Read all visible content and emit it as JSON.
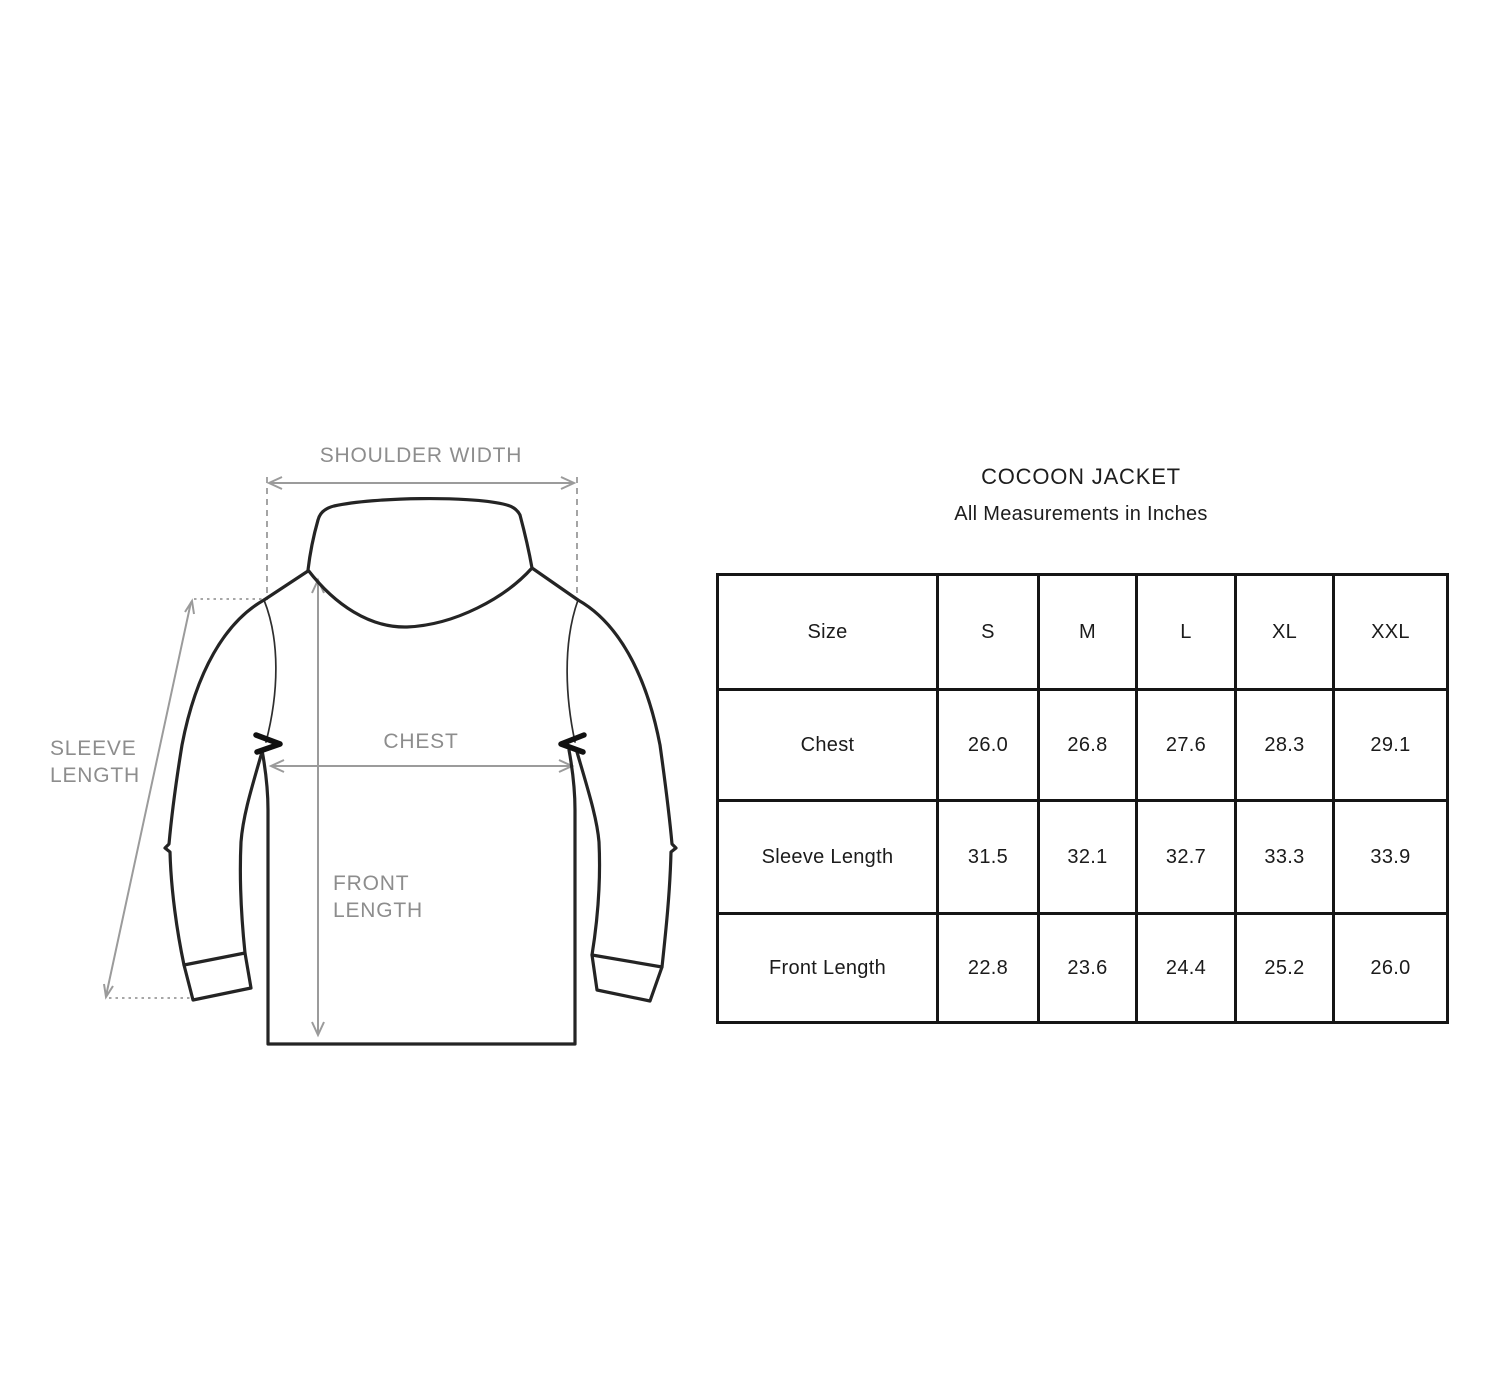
{
  "title": "COCOON JACKET",
  "subtitle": "All Measurements in Inches",
  "diagram": {
    "labels": {
      "shoulder_width": "SHOULDER WIDTH",
      "sleeve_length_line1": "SLEEVE",
      "sleeve_length_line2": "LENGTH",
      "chest": "CHEST",
      "front_length_line1": "FRONT",
      "front_length_line2": "LENGTH"
    },
    "colors": {
      "jacket_outline": "#242424",
      "annotation_arrows": "#9b9b9b",
      "label_text": "#8d8d8d"
    }
  },
  "size_table": {
    "columns": [
      "Size",
      "S",
      "M",
      "L",
      "XL",
      "XXL"
    ],
    "rows": [
      {
        "label": "Chest",
        "values": [
          "26.0",
          "26.8",
          "27.6",
          "28.3",
          "29.1"
        ]
      },
      {
        "label": "Sleeve Length",
        "values": [
          "31.5",
          "32.1",
          "32.7",
          "33.3",
          "33.9"
        ]
      },
      {
        "label": "Front Length",
        "values": [
          "22.8",
          "23.6",
          "24.4",
          "25.2",
          "26.0"
        ]
      }
    ],
    "border_color": "#151515",
    "text_color": "#1b1b1b",
    "background": "#ffffff"
  }
}
